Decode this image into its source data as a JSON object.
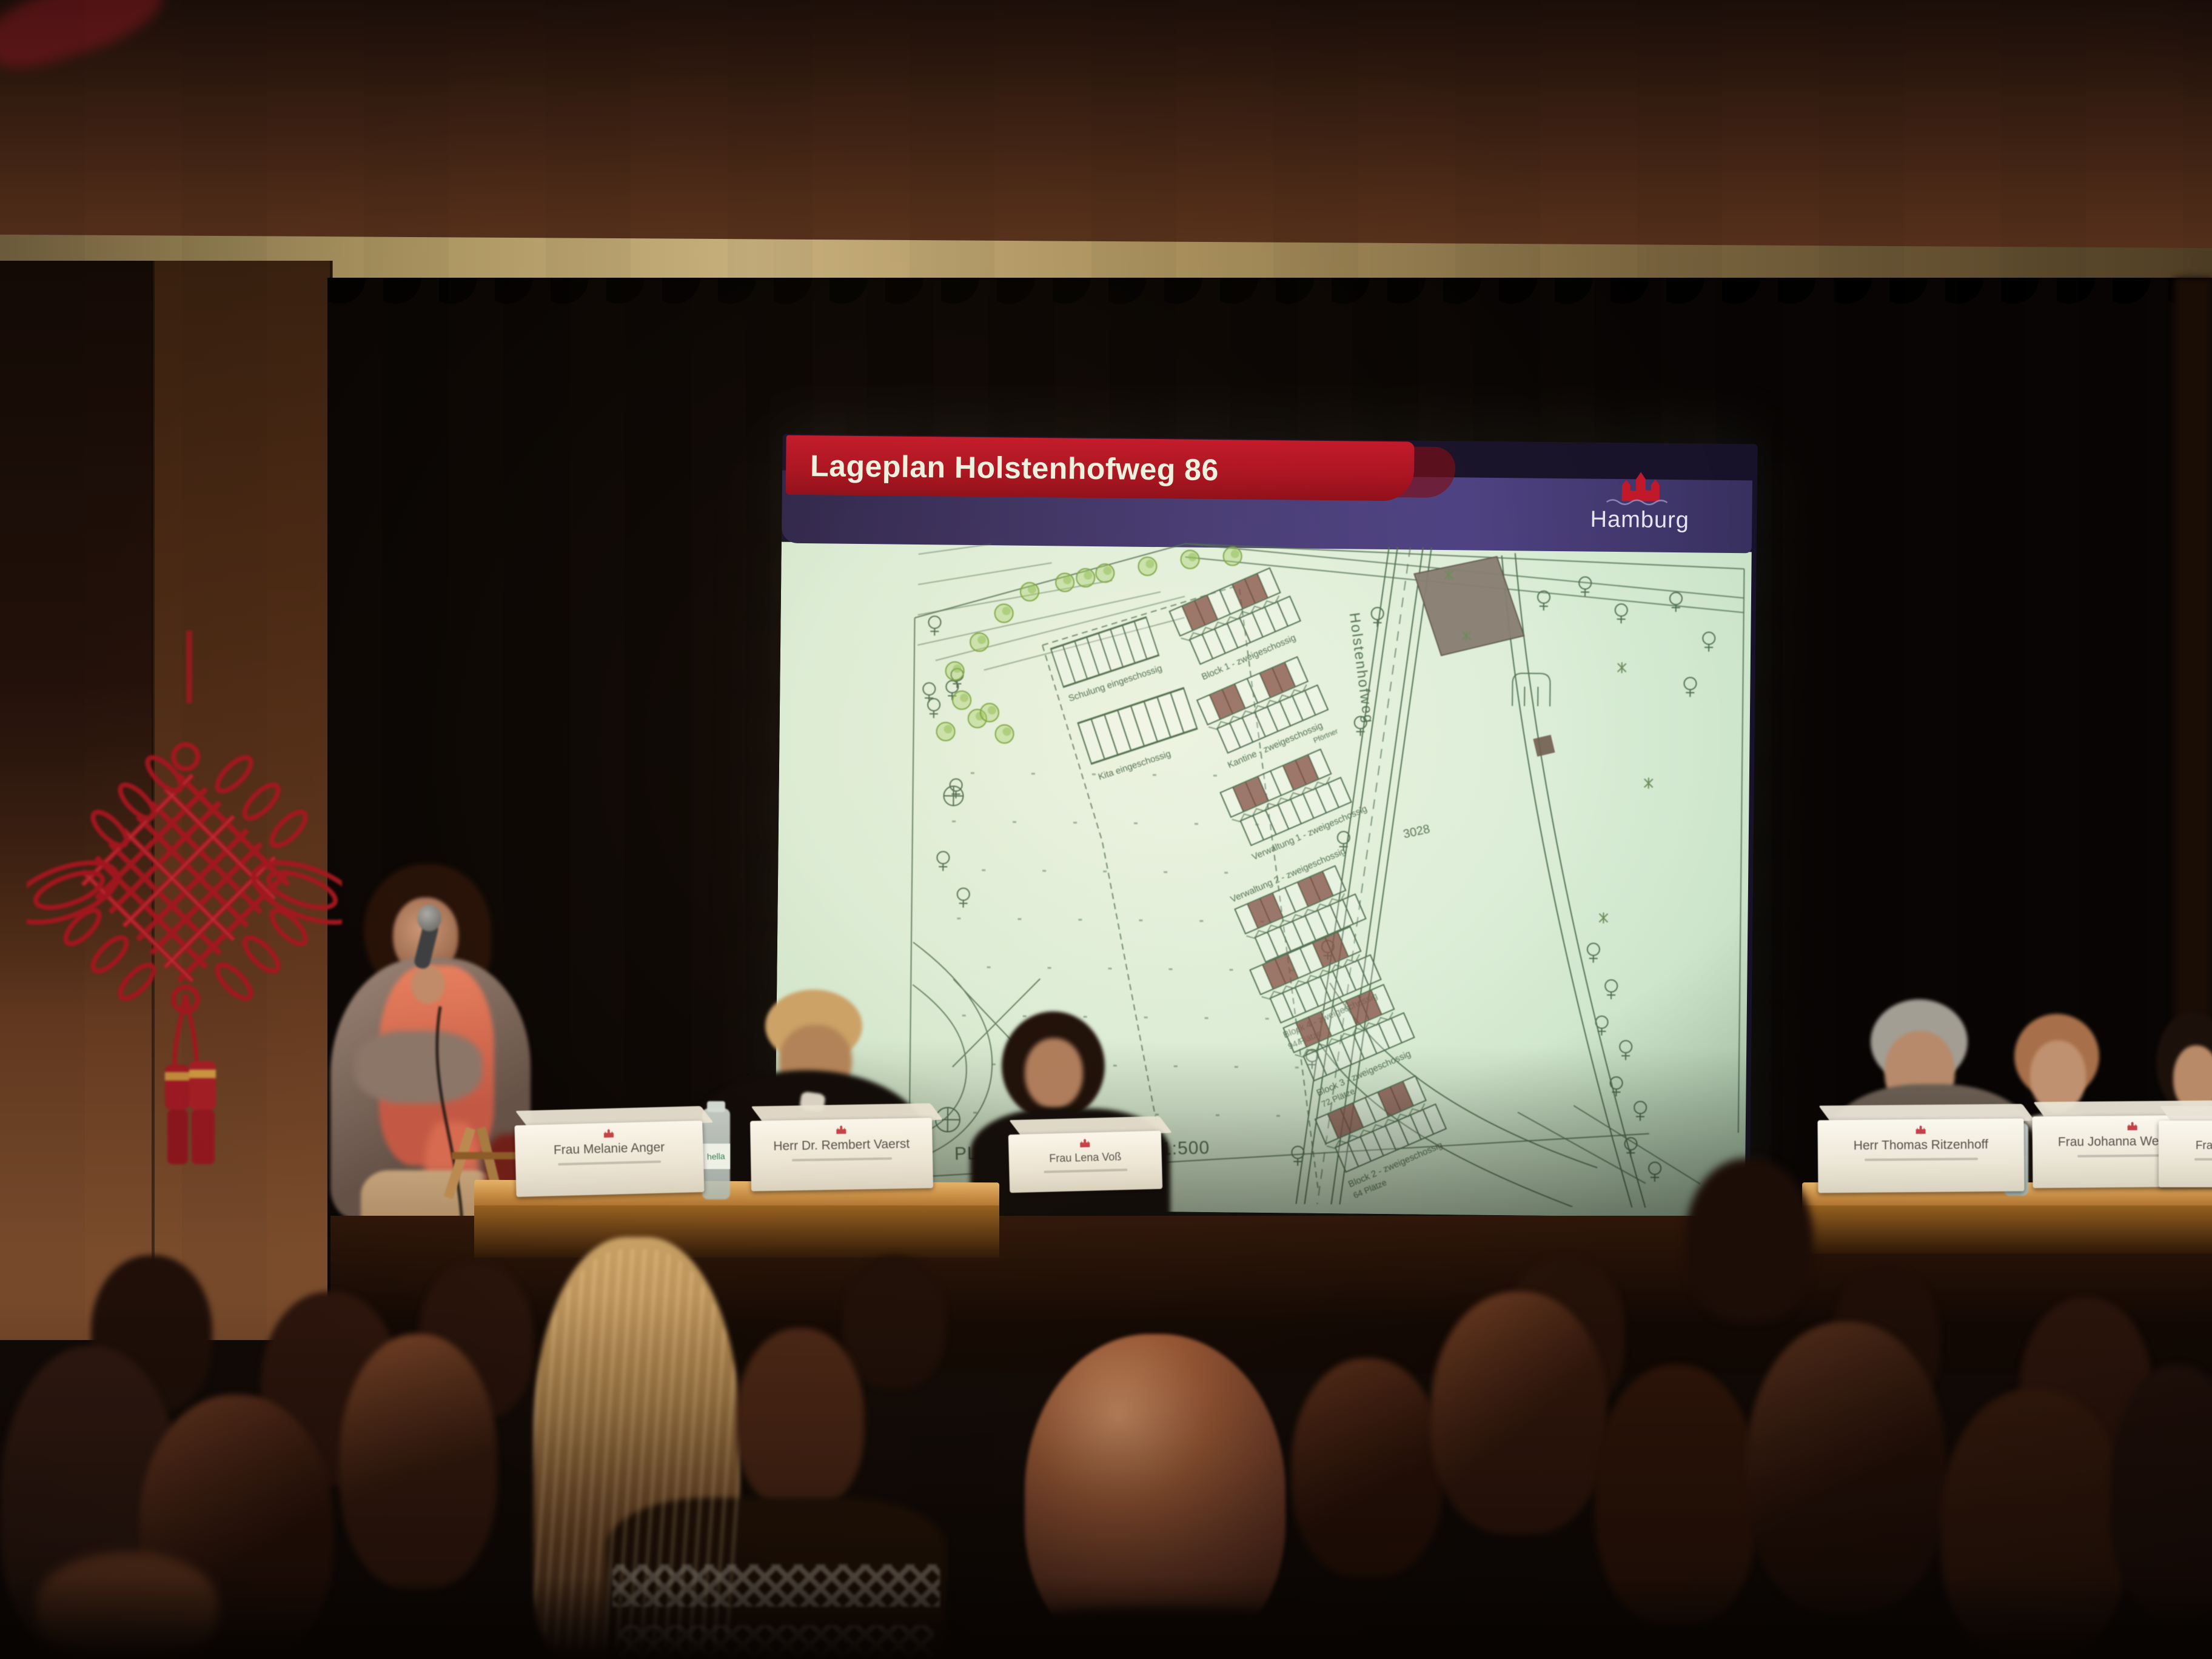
{
  "slide": {
    "title": "Lageplan Holstenhofweg 86",
    "logo_wordmark": "Hamburg",
    "plan": {
      "caption": "PLANINHALT, Maßstab 1:500",
      "street_label": "Holstenhofweg",
      "parcel_label": "3028",
      "buildings": {
        "schulung": "Schulung eingeschossig",
        "kita": "Kita eingeschossig",
        "block1": "Block 1 - zweigeschossig",
        "kantine": "Kantine - zweigeschossig",
        "pfoertner": "Pförtner",
        "verwaltung1": "Verwaltung 1 - zweigeschossig",
        "verwaltung2": "Verwaltung 2 - zweigeschossig",
        "block4": "Block 4 - zweigeschossig",
        "block4_plaetze": "94 Plätze",
        "block3": "Block 3 - zweigeschossig",
        "block3_plaetze": "72 Plätze",
        "block2": "Block 2 - zweigeschossig",
        "block2_plaetze": "64 Plätze"
      }
    }
  },
  "panel_left": {
    "cards": [
      "Frau Melanie Anger",
      "Herr Dr. Rembert Vaerst",
      "Frau Lena Voß"
    ],
    "bottle_label": "hella"
  },
  "panel_right": {
    "cards": [
      "Herr Thomas Ritzenhoff",
      "Frau Johanna Westphalen",
      "Frau Karen Vogt"
    ]
  },
  "colors": {
    "slide_header_red": "#b6141f",
    "slide_header_band": "#453a72",
    "plan_background": "#d8ecd6",
    "plan_linework": "#4f6f52",
    "knot_red": "#a3161f"
  }
}
